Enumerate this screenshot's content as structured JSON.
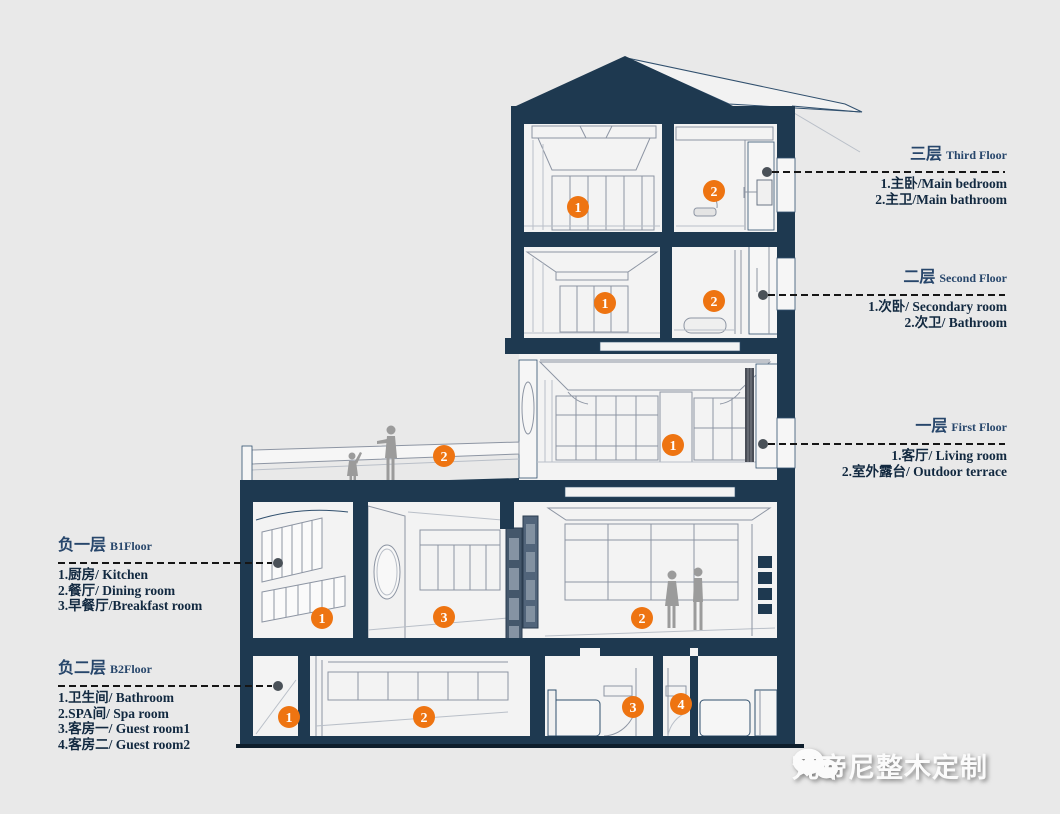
{
  "colors": {
    "background": "#e9e9e9",
    "structure_navy": "#1e3950",
    "marker_orange": "#ee7411",
    "label_title": "#27466b",
    "label_item": "#122940"
  },
  "floor_labels": [
    {
      "name": "third-floor",
      "title_zh": "三层",
      "title_en": "Third Floor",
      "items": [
        "1.主卧/Main bedroom",
        "2.主卫/Main bathroom"
      ]
    },
    {
      "name": "second-floor",
      "title_zh": "二层",
      "title_en": "Second Floor",
      "items": [
        "1.次卧/ Secondary room",
        "2.次卫/ Bathroom"
      ]
    },
    {
      "name": "first-floor",
      "title_zh": "一层",
      "title_en": "First Floor",
      "items": [
        "1.客厅/ Living room",
        "2.室外露台/ Outdoor terrace"
      ]
    },
    {
      "name": "b1-floor",
      "title_zh": "负一层",
      "title_en": "B1Floor",
      "items": [
        "1.厨房/ Kitchen",
        "2.餐厅/ Dining room",
        "3.早餐厅/Breakfast room"
      ]
    },
    {
      "name": "b2-floor",
      "title_zh": "负二层",
      "title_en": "B2Floor",
      "items": [
        "1.卫生间/ Bathroom",
        "2.SPA间/ Spa room",
        "3.客房一/ Guest room1",
        "4.客房二/ Guest room2"
      ]
    }
  ],
  "room_markers": [
    {
      "name": "third-floor-main-bedroom",
      "number": "1"
    },
    {
      "name": "third-floor-main-bathroom",
      "number": "2"
    },
    {
      "name": "second-floor-secondary-room",
      "number": "1"
    },
    {
      "name": "second-floor-bathroom",
      "number": "2"
    },
    {
      "name": "first-floor-living-room",
      "number": "1"
    },
    {
      "name": "first-floor-outdoor-terrace",
      "number": "2"
    },
    {
      "name": "b1-kitchen",
      "number": "1"
    },
    {
      "name": "b1-dining-room",
      "number": "2"
    },
    {
      "name": "b1-breakfast-room",
      "number": "3"
    },
    {
      "name": "b2-bathroom",
      "number": "1"
    },
    {
      "name": "b2-spa-room",
      "number": "2"
    },
    {
      "name": "b2-guest-room-1",
      "number": "3"
    },
    {
      "name": "b2-guest-room-2",
      "number": "4"
    }
  ],
  "watermark": {
    "brand": "梵帝尼整木定制",
    "icon": "wechat-icon"
  }
}
